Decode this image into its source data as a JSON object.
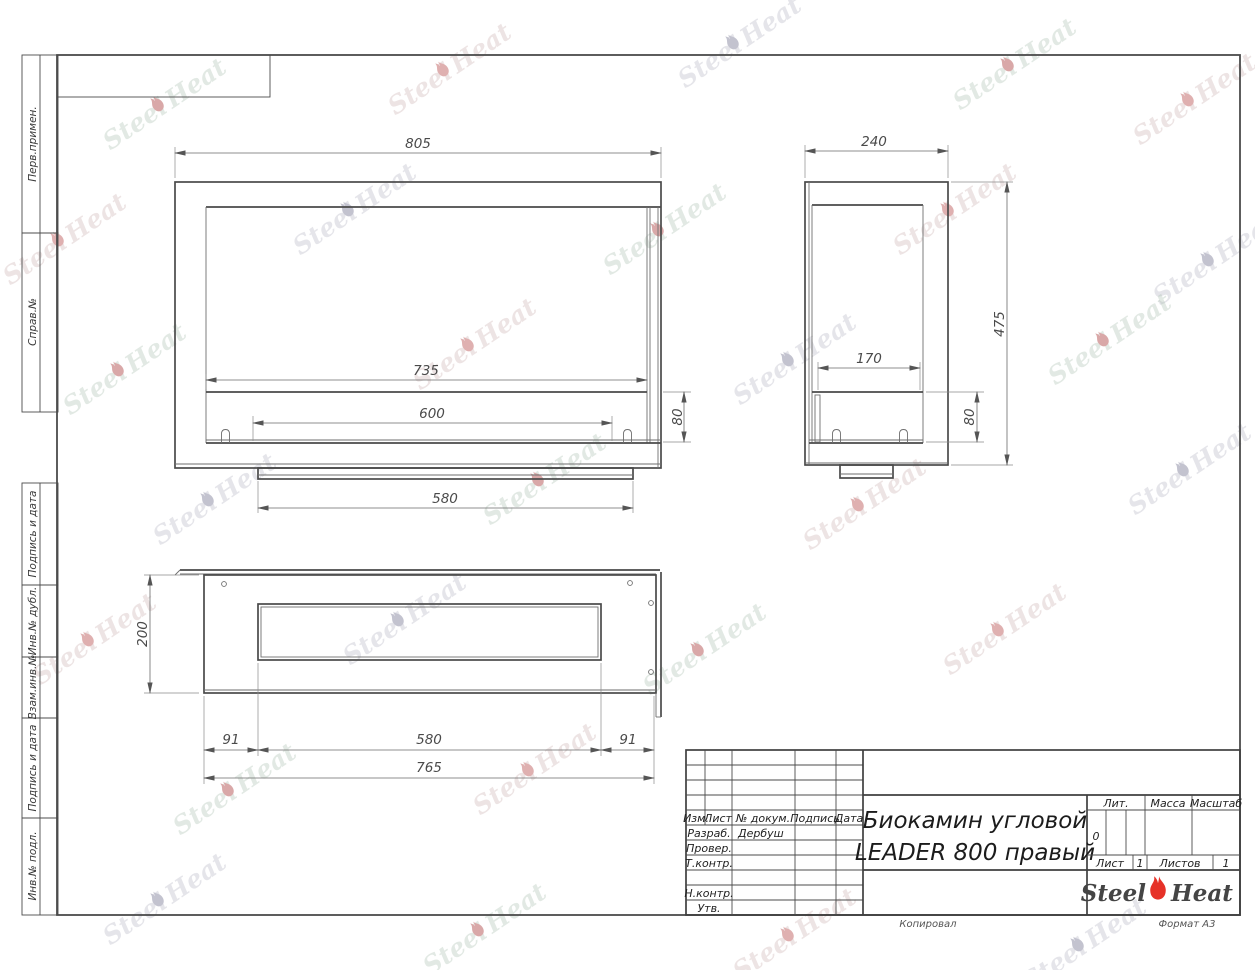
{
  "sheet": {
    "copied_label": "Копировал",
    "format_label": "Формат A3"
  },
  "margins": {
    "perv_primen": "Перв.примен.",
    "sprav_no": "Справ.№",
    "podpis_data_1": "Подпись и дата",
    "inv_dubl": "Инв.№ дубл.",
    "vzam_inv": "Взам.инв.№",
    "podpis_data_2": "Подпись и дата",
    "inv_podl": "Инв.№ подл."
  },
  "title_block": {
    "name_line1": "Биокамин угловой",
    "name_line2": "LEADER 800 правый",
    "col_izm": "Изм.",
    "col_list": "Лист",
    "col_doc": "№ докум.",
    "col_sign": "Подпись",
    "col_date": "Дата",
    "row_developed": "Разраб.",
    "developer_name": "Дербуш",
    "row_checked": "Провер.",
    "row_tcontrol": "Т.контр.",
    "row_ncontrol": "Н.контр.",
    "row_approved": "Утв.",
    "lit_label": "Лит.",
    "lit_value": "0",
    "mass_label": "Масса",
    "scale_label": "Масштаб",
    "sheet_label": "Лист",
    "sheet_value": "1",
    "sheets_label": "Листов",
    "sheets_value": "1",
    "logo_part1": "Steel",
    "logo_part2": "Heat",
    "flame_color": "#e63228"
  },
  "watermark": {
    "part1": "Steel",
    "part2": "Heat"
  },
  "dimensions": {
    "front": {
      "width": "805",
      "opening": "735",
      "burner": "600",
      "foot": "580",
      "burner_height": "80"
    },
    "side": {
      "depth": "240",
      "opening": "170",
      "burner_height": "80",
      "height": "475"
    },
    "plan": {
      "depth": "200",
      "offset_left": "91",
      "slot": "580",
      "offset_right": "91",
      "total": "765"
    }
  }
}
